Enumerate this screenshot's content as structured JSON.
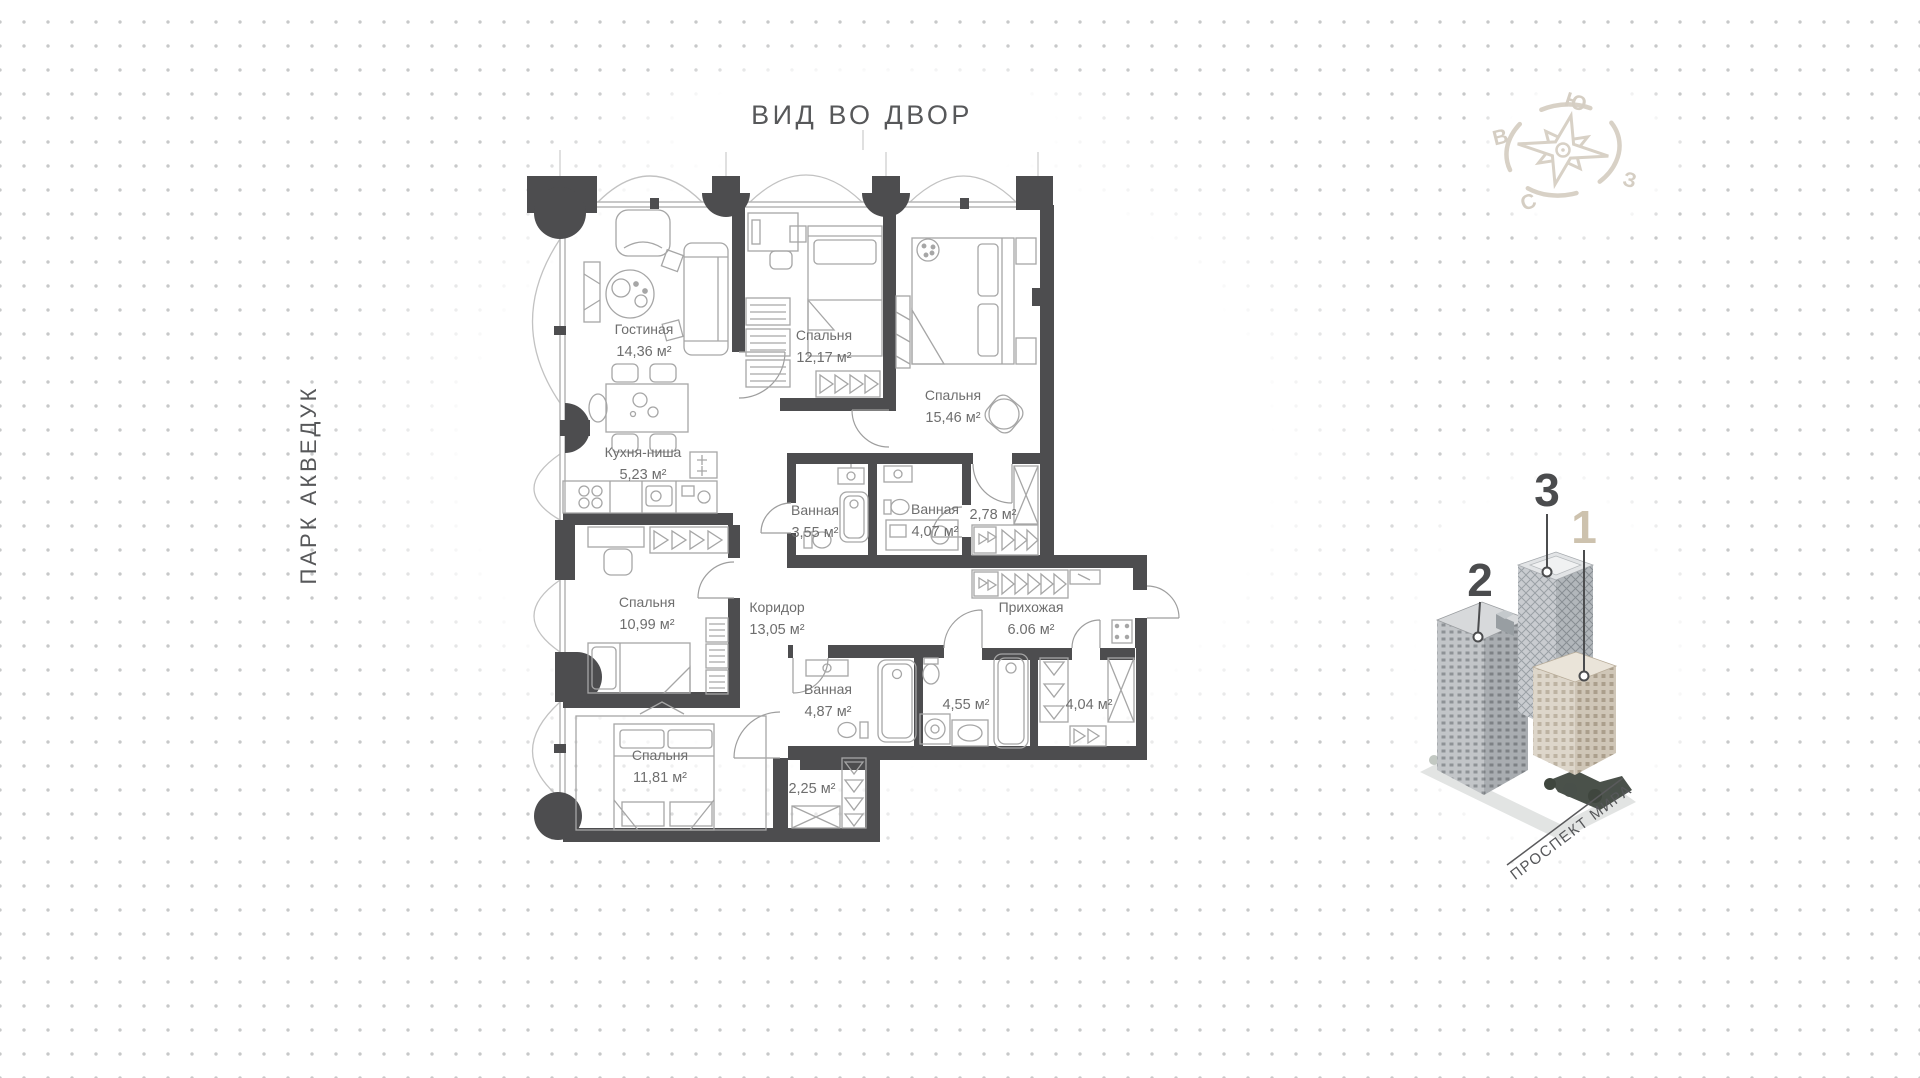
{
  "title": "ВИД ВО ДВОР",
  "park_label": "ПАРК АКВЕДУК",
  "compass": {
    "south": "Ю",
    "east": "В",
    "west": "З",
    "north": "С"
  },
  "rooms": [
    {
      "name": "Гостиная",
      "area": "14,36 м²"
    },
    {
      "name": "Спальня",
      "area": "12,17 м²"
    },
    {
      "name": "Спальня",
      "area": "15,46 м²"
    },
    {
      "name": "Кухня-ниша",
      "area": "5,23 м²"
    },
    {
      "name": "Ванная",
      "area": "3,55 м²"
    },
    {
      "name": "Ванная",
      "area": "4,07 м²"
    },
    {
      "name": "",
      "area": "2,78 м²"
    },
    {
      "name": "Спальня",
      "area": "10,99 м²"
    },
    {
      "name": "Коридор",
      "area": "13,05 м²"
    },
    {
      "name": "Прихожая",
      "area": "6.06 м²"
    },
    {
      "name": "Ванная",
      "area": "4,87 м²"
    },
    {
      "name": "",
      "area": "4,55 м²"
    },
    {
      "name": "",
      "area": "4,04 м²"
    },
    {
      "name": "Спальня",
      "area": "11,81 м²"
    },
    {
      "name": "",
      "area": "2,25 м²"
    }
  ],
  "building_diagram": {
    "numbers": [
      "2",
      "3",
      "1"
    ],
    "highlighted_number": "1",
    "street": "ПРОСПЕКТ МИРА"
  },
  "colors": {
    "wall": "#4d4d4f",
    "label_text": "#6e6e6e",
    "title_text": "#57585a",
    "accent_beige": "#cdc2ae",
    "dots": "#c7c8c9"
  }
}
